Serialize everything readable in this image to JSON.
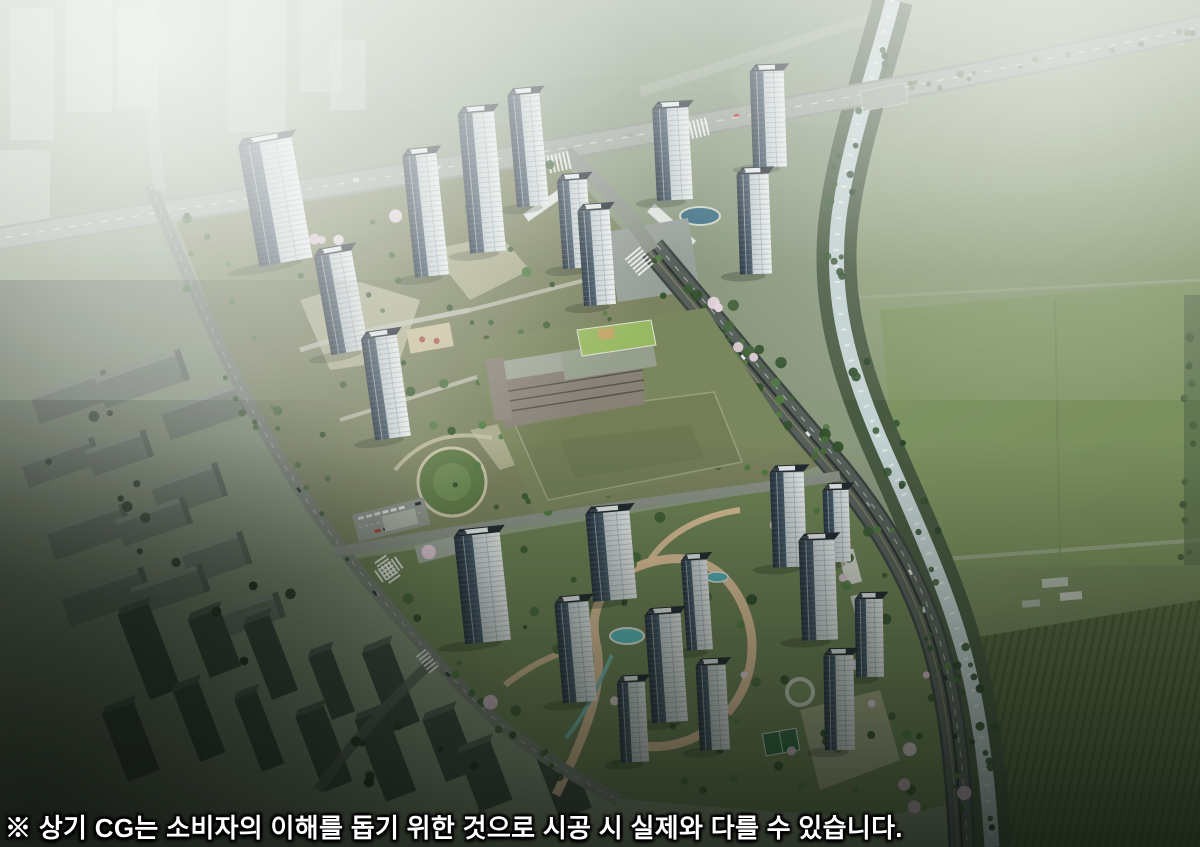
{
  "image": {
    "kind": "apartment-complex-aerial-cg-rendering",
    "description": "Bird's-eye computer-graphics rendering of a planned high-rise apartment complex with landscaped grounds, a school with a playing field, perimeter boulevards, an adjacent stream, farmland to the right and a hazy existing city to the left"
  },
  "caption": {
    "text": "※ 상기 CG는 소비자의 이해를 돕기 위한 것으로 시공 시 실제와 다를 수 있습니다."
  },
  "scene": {
    "regions": [
      "existing-city-in-haze",
      "upper-apartment-cluster",
      "lower-apartment-cluster",
      "school-with-field",
      "stream-with-tree-banks",
      "farmland",
      "boulevard-road-network",
      "cherry-blossom-landscaping",
      "disclaimer-caption"
    ]
  },
  "palette": {
    "base_ground": "#8d9a80",
    "farm_top": "#a9b29c",
    "farm_mid": "#86976c",
    "farm_low": "#75875c",
    "farm_rows": "#57673f",
    "water": "#c8d6d8",
    "water_bank": "#45543d",
    "road_major": "#585e5b",
    "road_minor": "#7c837a",
    "road_hazy": "#a0a79d",
    "parcel_upper": "#7c825f",
    "parcel_lower": "#6f8355",
    "paving_tan": "#c6c2a4",
    "path_salmon": "#edc9a1",
    "pond": "#59c1c1",
    "school_grounds": "#7c865e",
    "school_field": "#747e57",
    "school_wall": "#8a8178",
    "school_roof": "#a5aa9c",
    "school_green_roof": "#9cbd63",
    "tower_facade": "#e7eaed",
    "tower_glass": "#2e3947",
    "tower_roof": "#1f252d",
    "tower_penthouse": "#edf0f2",
    "tree_dark": "#3a5a31",
    "tree_mid": "#46683a",
    "blossom": "#e8cedd",
    "city_slab": "#717c70",
    "city_dark_slab": "#3d463e",
    "fog": "#ffffff",
    "shadow_dark": "#090d09",
    "caption_color": "#ffffff"
  }
}
